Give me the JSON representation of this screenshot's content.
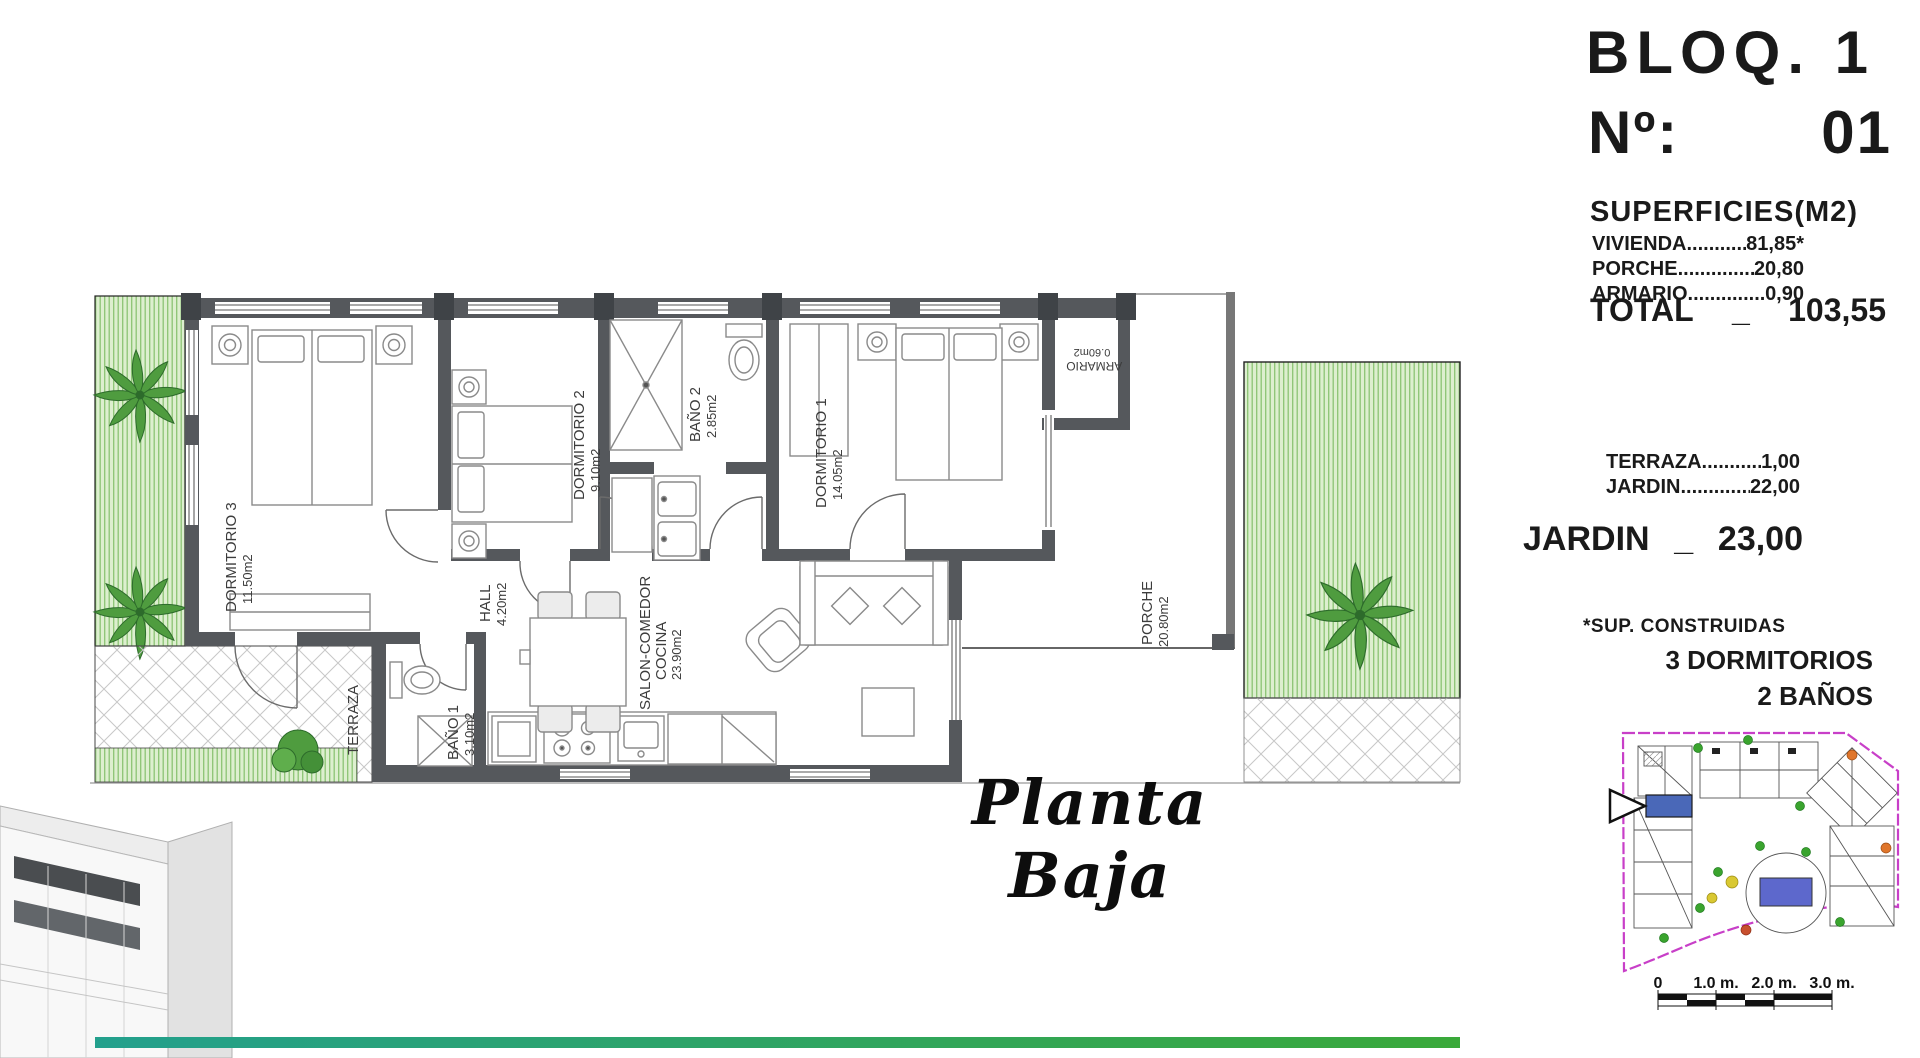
{
  "header": {
    "block": "BLOQ. 1",
    "unit_label": "Nº:",
    "unit_number": "01"
  },
  "leader": "....................................................",
  "surfaces": {
    "title": "SUPERFICIES(M2)",
    "rows": [
      {
        "label": "VIVIENDA",
        "value": "81,85*"
      },
      {
        "label": "PORCHE",
        "value": "20,80"
      },
      {
        "label": "ARMARIO",
        "value": "0,90"
      }
    ],
    "total": {
      "label": "TOTAL",
      "separator": "_",
      "value": "103,55"
    }
  },
  "exterior": {
    "rows": [
      {
        "label": "TERRAZA",
        "value": "1,00"
      },
      {
        "label": "JARDIN",
        "value": "22,00"
      }
    ],
    "total": {
      "label": "JARDIN",
      "separator": "_",
      "value": "23,00"
    }
  },
  "notes": {
    "footnote": "*SUP. CONSTRUIDAS",
    "bedrooms": "3 DORMITORIOS",
    "bathrooms": "2 BAÑOS"
  },
  "plan": {
    "title": "Planta Baja",
    "rooms": {
      "dormitorio3": {
        "name": "DORMITORIO 3",
        "area": "11.50m2"
      },
      "dormitorio2": {
        "name": "DORMITORIO 2",
        "area": "9.10m2"
      },
      "bano2": {
        "name": "BAÑO 2",
        "area": "2.85m2"
      },
      "dormitorio1": {
        "name": "DORMITORIO 1",
        "area": "14.05m2"
      },
      "hall": {
        "name": "HALL",
        "area": "4.20m2"
      },
      "bano1": {
        "name": "BAÑO 1",
        "area": "3.10m2"
      },
      "salon": {
        "line1": "SALON-COMEDOR",
        "line2": "COCINA",
        "area": "23.90m2"
      },
      "porche": {
        "name": "PORCHE",
        "area": "20.80m2"
      },
      "terraza": {
        "name": "TERRAZA"
      },
      "armario": {
        "name": "ARMARIO",
        "area": "0.60m2"
      }
    }
  },
  "site_plan": {
    "scale_ticks": [
      "0",
      "1.0 m.",
      "2.0 m.",
      "3.0 m."
    ]
  },
  "colors": {
    "wall_gray": "#55585c",
    "garden_fill": "#ddefcf",
    "garden_stripe": "#8cc474",
    "palm_green": "#4f9c3f",
    "site_border_magenta": "#c83fc8",
    "unit_highlight_blue": "#4a68b8",
    "pool_blue": "#5d68cc",
    "footer_teal": "#23a08d",
    "footer_green": "#3aa93a"
  }
}
